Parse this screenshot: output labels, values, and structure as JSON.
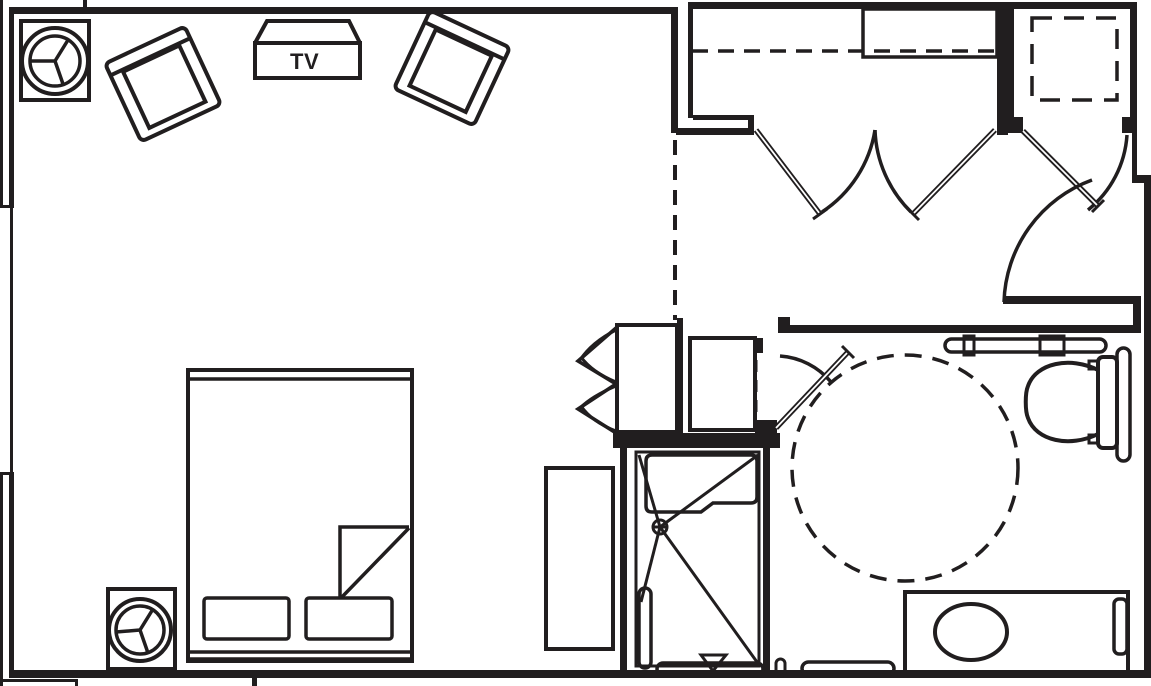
{
  "meta": {
    "type": "architectural-floor-plan",
    "description": "Accessible hotel guest room floor plan, black linework on white",
    "canvas_width": 1151,
    "canvas_height": 686,
    "ink_color": "#211e1f",
    "background_color": "#ffffff"
  },
  "labels": {
    "tv": "TV"
  },
  "rooms": [
    {
      "name": "bedroom-living-area"
    },
    {
      "name": "entry-corridor"
    },
    {
      "name": "closet"
    },
    {
      "name": "storage-room"
    },
    {
      "name": "bathroom"
    },
    {
      "name": "roll-in-shower"
    }
  ],
  "furniture": [
    {
      "name": "nightstand-with-lamp",
      "count": 2
    },
    {
      "name": "lounge-chair",
      "count": 2
    },
    {
      "name": "tv-credenza",
      "label": "TV"
    },
    {
      "name": "bed-with-pillows-and-folded-blanket",
      "count": 1
    },
    {
      "name": "dresser",
      "count": 1
    }
  ],
  "fixtures": [
    {
      "name": "roll-in-shower",
      "parts": [
        "fold-down-bench",
        "floor-drain",
        "slope-lines",
        "grab-bars",
        "control-triangle"
      ]
    },
    {
      "name": "toilet",
      "parts": [
        "tank",
        "elongated-bowl",
        "rear-grab-bar",
        "side-grab-bar"
      ]
    },
    {
      "name": "vanity",
      "parts": [
        "counter",
        "oval-sink",
        "towel-bar"
      ]
    },
    {
      "name": "closet",
      "parts": [
        "shelf",
        "hanging-rod-dashed",
        "double-swing-doors"
      ]
    },
    {
      "name": "entry-closet",
      "parts": [
        "bi-fold-doors"
      ]
    },
    {
      "name": "storage-room",
      "parts": [
        "dashed-shelf-square",
        "swing-door"
      ]
    }
  ],
  "accessibility": {
    "turning_circle": {
      "cx": 905,
      "cy": 468,
      "radius": 113,
      "style": "dashed"
    }
  }
}
